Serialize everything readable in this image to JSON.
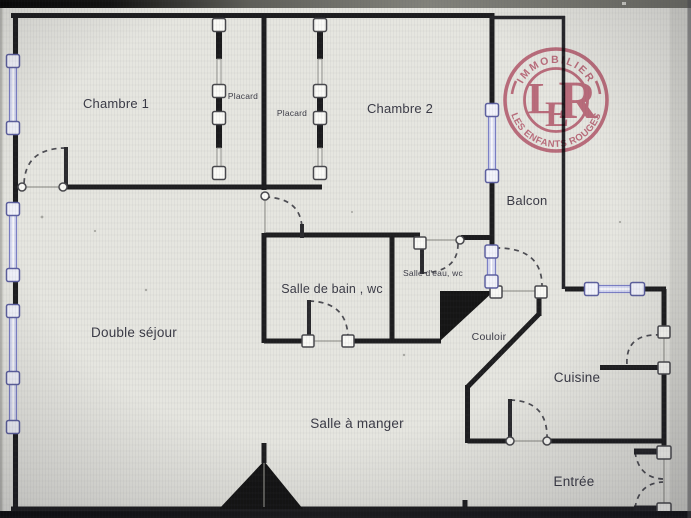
{
  "labels": {
    "chambre1": "Chambre 1",
    "placard1": "Placard",
    "placard2": "Placard",
    "chambre2": "Chambre 2",
    "balcon": "Balcon",
    "salle_de_bain": "Salle de bain , wc",
    "salle_d_eau": "Salle d'eau, wc",
    "double_sejour": "Double séjour",
    "couloir": "Couloir",
    "cuisine": "Cuisine",
    "salle_a_manger": "Salle à manger",
    "entree": "Entrée"
  },
  "stamp": {
    "arc_top": "IMMOBILIER",
    "arc_bottom": "LES ENFANTS ROUGES",
    "monogram_l": "L",
    "monogram_e": "E",
    "monogram_r": "R"
  },
  "colors": {
    "wall": "#1d1d1f",
    "window": "#7c80c7",
    "window_fill": "#d9dcf2",
    "door_arc": "#4c4c52",
    "label_text": "#3a3a45",
    "stamp": "#c2566f",
    "paper": "#e6e6e0"
  }
}
